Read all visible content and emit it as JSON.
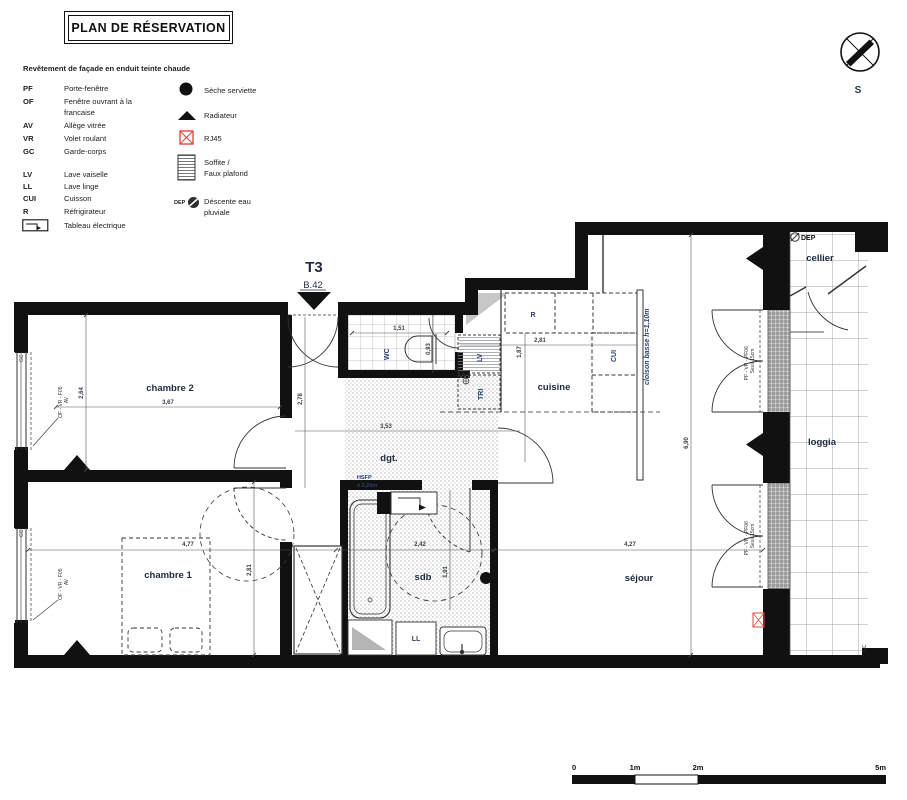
{
  "header": {
    "title": "PLAN DE RÉSERVATION"
  },
  "compass": {
    "label": "S"
  },
  "legend": {
    "intro": "Revêtement de façade en enduit teinte chaude",
    "abbreviations": [
      {
        "abbr": "PF",
        "label": "Porte-fenêtre"
      },
      {
        "abbr": "OF",
        "label": "Fenêtre ouvrant à la\nfrancaise"
      },
      {
        "abbr": "AV",
        "label": "Allège vitrée"
      },
      {
        "abbr": "VR",
        "label": "Volet roulant"
      },
      {
        "abbr": "GC",
        "label": "Garde-corps"
      },
      {
        "abbr": "LV",
        "label": "Lave vaiselle"
      },
      {
        "abbr": "LL",
        "label": "Lave linge"
      },
      {
        "abbr": "CUI",
        "label": "Cuisson"
      },
      {
        "abbr": "R",
        "label": "Réfrigirateur"
      },
      {
        "abbr": "",
        "label": "Tableau électrique"
      }
    ],
    "symbols": [
      {
        "name": "seche-serviette",
        "label": "Sèche serviette"
      },
      {
        "name": "radiateur",
        "label": "Radiateur"
      },
      {
        "name": "rj45",
        "label": "RJ45"
      },
      {
        "name": "soffite",
        "label": "Soffite /\nFaux plafond"
      },
      {
        "name": "descente-eau",
        "label": "Déscente eau\npluviale",
        "prefix": "DEP"
      }
    ]
  },
  "unit": {
    "type": "T3",
    "lot": "B.42"
  },
  "rooms": {
    "chambre2": "chambre 2",
    "chambre1": "chambre 1",
    "wc": "WC",
    "dgt": "dgt.",
    "cuisine": "cuisine",
    "sdb": "sdb",
    "sejour": "séjour",
    "cellier": "cellier",
    "loggia": "loggia"
  },
  "appliances": {
    "fridge": "R",
    "dishwasher": "LV",
    "tri": "TRI",
    "cooktop": "CUI",
    "washer": "LL"
  },
  "dimensions": {
    "chambre2_width": "3,67",
    "chambre2_height": "2,64",
    "chambre1_width": "4,77",
    "chambre1_height": "2,81",
    "wc_width": "1,51",
    "wc_depth": "0,93",
    "entry_height": "2,78",
    "dgt_width": "3,53",
    "cuisine_width": "2,81",
    "cuisine_height": "1,87",
    "sdb_width": "2,42",
    "sdb_height": "1,91",
    "sejour_width": "4,27",
    "sejour_height": "6,90"
  },
  "annotations": {
    "hsfp_line1": "HSFP",
    "hsfp_line2": "± 2,20m",
    "cloison": "cloison basse h=1,10m",
    "pf06_line1": "PF - VR - PF06",
    "pf06_line2": "Seuil 15cm",
    "window_line1": "OF - VR - F05",
    "window_line2": "AV",
    "gc": "GC",
    "dep": "DEP"
  },
  "scale_bar": {
    "ticks": [
      "0",
      "1m",
      "2m",
      "5m"
    ]
  },
  "colors": {
    "rj45_red": "#e0493f",
    "label_navy": "#1e2940",
    "wall_black": "#111111"
  }
}
